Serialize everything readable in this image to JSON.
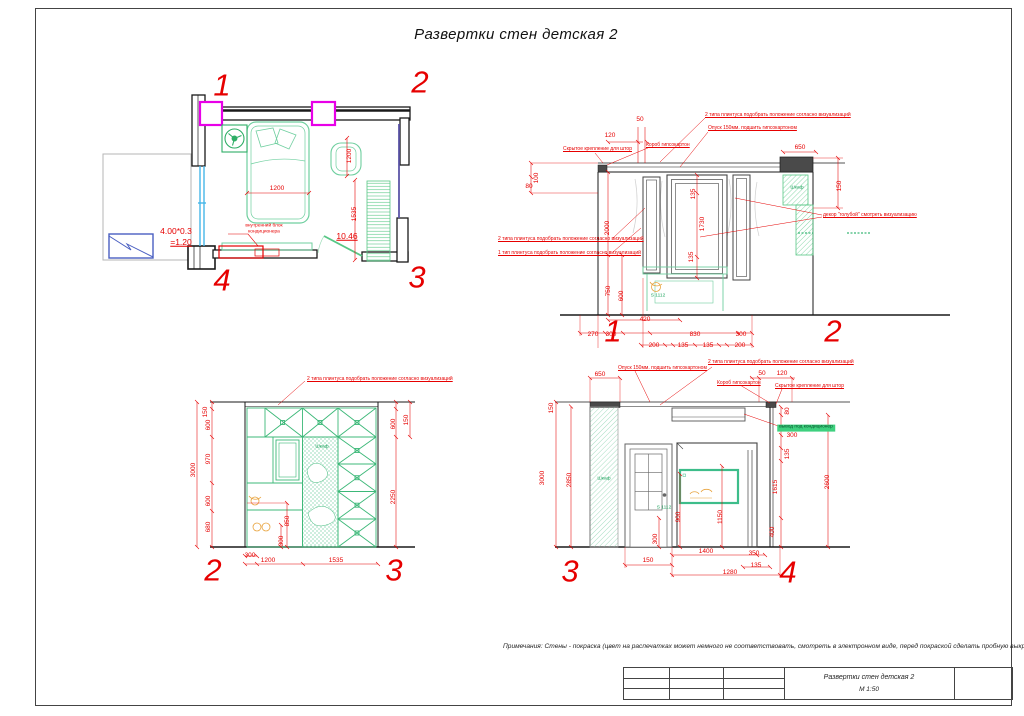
{
  "sheet": {
    "title": "Развертки стен  детская 2",
    "note": "Примечания: Стены - покраска (цвет на распечатках может немного не соответствовать, смотреть в электронном виде, перед покраской сделать пробную выкраску)",
    "titleblock": {
      "drawing_name": "Развертки стен детская 2",
      "scale": "М 1:50"
    }
  },
  "colors": {
    "dim_red": "#e60000",
    "furniture_green": "#57c785",
    "lattice_green": "#3cb878",
    "column_magenta": "#e800e8",
    "window_blue": "#45b5e8",
    "frame_blue": "#4a5fc1",
    "track_purple": "#5b55a8",
    "highlight_green_bg": "#3ed07e"
  },
  "plan": {
    "markers": {
      "k1": "1",
      "k2": "2",
      "k3": "3",
      "k4": "4"
    },
    "dims": {
      "bed": "1200",
      "chair": "1200",
      "wardrobe": "1535"
    },
    "area": "10.46",
    "window_formula": "4.00*0.3",
    "window_result": "=1.20",
    "ac_line1": "внутренний блок",
    "ac_line2": "кондиционера"
  },
  "elev12": {
    "marker_left": "1",
    "marker_right": "2",
    "labels": {
      "plinth2_top": "2 типа плинтуса подобрать положение согласно визуализаций",
      "drop": "Опуск 150мм. подшить гипсокартоном",
      "curtain": "Скрытое крепление для штор",
      "gkl_box": "Короб гипсокартон",
      "decor": "декор \"голубой\" смотреть визуализацию",
      "plinth2": "2 типа плинтуса подобрать положение согласно визуализаций",
      "plinth1": "1 тип плинтуса подобрать положение согласно визуализаций",
      "wardrobe": "Шкаф",
      "desk_code": "S 1112"
    },
    "dims": {
      "top_120": "120",
      "top_50": "50",
      "top_650": "650",
      "left_80": "80",
      "left_100": "100",
      "left_2000": "2000",
      "right_150": "150",
      "win_135_top": "135",
      "win_1730": "1730",
      "win_135_bot": "135",
      "left_750": "750",
      "left_600": "600",
      "bot_420": "420",
      "bot_270": "270",
      "bot_300_1": "300",
      "bot_200_1": "200",
      "bot_830": "830",
      "bot_135_1": "135",
      "bot_135_2": "135",
      "bot_300_2": "300",
      "bot_200_2": "200"
    }
  },
  "elev23": {
    "marker_left": "2",
    "marker_right": "3",
    "labels": {
      "plinth2_top": "2 типа плинтуса подобрать положение согласно визуализаций",
      "wardrobe": "Шкаф"
    },
    "dims": {
      "left_150": "150",
      "left_600_1": "600",
      "left_970": "970",
      "left_600_2": "600",
      "left_680": "680",
      "left_3000": "3000",
      "right_600": "600",
      "right_150": "150",
      "right_2250": "2250",
      "bot_300": "300",
      "bot_1200": "1200",
      "bot_1535": "1535",
      "in_850": "850",
      "in_300": "300"
    }
  },
  "elev34": {
    "marker_left": "3",
    "marker_right": "4",
    "labels": {
      "drop": "Опуск 150мм. подшить гипсокартоном",
      "plinth2_top": "2 типа плинтуса подобрать положение согласно визуализаций",
      "gkl_box": "Короб гипсокартон",
      "curtain": "Скрытое крепление для штор",
      "ac_outlet": "вывод под кондиционер",
      "wardrobe": "Шкаф",
      "desk_code": "S 1112"
    },
    "dims": {
      "top_650": "650",
      "top_50": "50",
      "top_120": "120",
      "left_150": "150",
      "left_3000": "3000",
      "left_2850": "2850",
      "right_80": "80",
      "right_300": "300",
      "right_135": "135",
      "right_1615": "1615",
      "right_2600": "2600",
      "right_400": "400",
      "in_900": "900",
      "in_1150": "1150",
      "in_300": "300",
      "bot_150": "150",
      "bot_1400": "1400",
      "bot_350": "350",
      "bot_135": "135",
      "bot_1280": "1280"
    }
  }
}
